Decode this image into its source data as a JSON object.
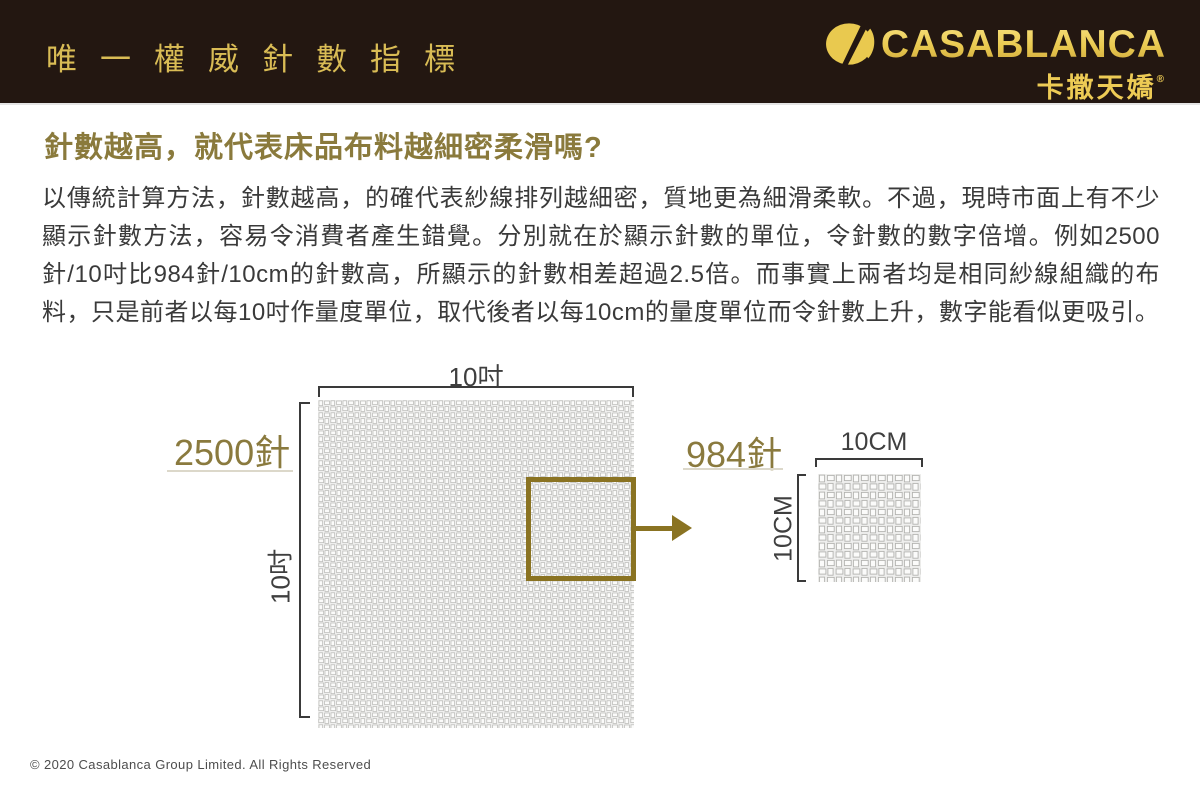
{
  "header": {
    "title": "唯一權威針數指標",
    "brand": {
      "name": "CASABLANCA",
      "chinese": "卡撒天嬌",
      "registered_mark": "®"
    }
  },
  "article": {
    "heading": "針數越高，就代表床品布料越細密柔滑嗎?",
    "body": "以傳統計算方法，針數越高，的確代表紗線排列越細密，質地更為細滑柔軟。不過，現時市面上有不少顯示針數方法，容易令消費者產生錯覺。分別就在於顯示針數的單位，令針數的數字倍增。例如2500針/10吋比984針/10cm的針數高，所顯示的針數相差超過2.5倍。而事實上兩者均是相同紗線組織的布料，只是前者以每10吋作量度單位，取代後者以每10cm的量度單位而令針數上升，數字能看似更吸引。"
  },
  "diagram": {
    "large_swatch": {
      "stitch_count": "2500針",
      "width_label": "10吋",
      "height_label": "10吋"
    },
    "small_swatch": {
      "stitch_count": "984針",
      "width_label": "10CM",
      "height_label": "10CM"
    }
  },
  "footer": {
    "copyright": "© 2020  Casablanca Group Limited. All Rights Reserved"
  },
  "colors": {
    "header_bg": "#231711",
    "header_title_gold": "#D9BC55",
    "brand_gold": "#EDCB55",
    "heading_gold": "#8A7A3C",
    "accent_gold": "#8A7322",
    "body_text": "#3A3A3A"
  }
}
